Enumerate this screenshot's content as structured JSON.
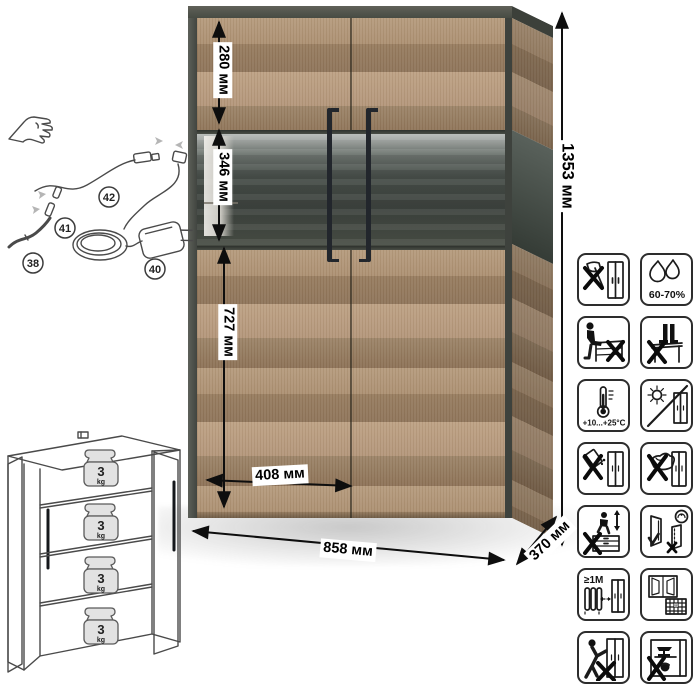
{
  "dimensions": {
    "top_section": "280 мм",
    "display_section": "346 мм",
    "bottom_section": "727 мм",
    "door_width": "408 мм",
    "total_width": "858 мм",
    "depth": "370 мм",
    "total_height": "1353 мм"
  },
  "led_kit": {
    "callouts": [
      {
        "id": "42",
        "part": "led-cable"
      },
      {
        "id": "41",
        "part": "cable-connector"
      },
      {
        "id": "38",
        "part": "led-strip"
      },
      {
        "id": "40",
        "part": "power-adapter"
      }
    ]
  },
  "load_schematic": {
    "shelf_count": 4,
    "weight_value": "3",
    "weight_unit": "kg"
  },
  "care_icons": [
    {
      "name": "no-sharp-tools"
    },
    {
      "name": "humidity-range",
      "label": "60-70%"
    },
    {
      "name": "no-sitting-on-furniture"
    },
    {
      "name": "no-standing-on-furniture"
    },
    {
      "name": "temperature-range",
      "label": "+10...+25°C"
    },
    {
      "name": "no-direct-sunlight"
    },
    {
      "name": "no-spilling-liquids"
    },
    {
      "name": "no-abrasive-cleaning"
    },
    {
      "name": "no-climbing"
    },
    {
      "name": "close-doors-gently"
    },
    {
      "name": "radiator-distance",
      "label": "≥1M"
    },
    {
      "name": "ventilate-room",
      "calendar_day": "21"
    },
    {
      "name": "no-dragging"
    },
    {
      "name": "no-heavy-objects-inside"
    }
  ],
  "colors": {
    "wood_light": "#b59b7d",
    "wood_dark": "#8c7156",
    "frame": "#474b43",
    "glass": "#454b46",
    "handle": "#22262c"
  }
}
